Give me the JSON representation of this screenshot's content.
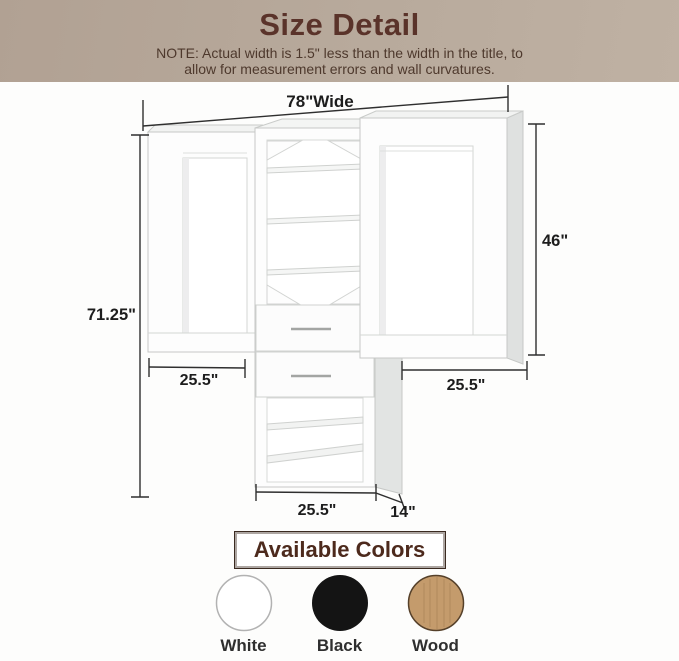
{
  "header": {
    "title": "Size Detail",
    "note_line1": "NOTE: Actual width is 1.5\" less than the width in the title, to",
    "note_line2": "allow for measurement errors and wall curvatures."
  },
  "diagram": {
    "product": "closet organizer system",
    "dimensions": {
      "total_width": "78\"Wide",
      "total_height": "71.25\"",
      "right_section_height": "46\"",
      "left_section_width": "25.5\"",
      "right_section_width": "25.5\"",
      "tower_width": "25.5\"",
      "tower_depth": "14\""
    }
  },
  "colors_section": {
    "title": "Available Colors",
    "options": [
      {
        "label": "White",
        "hex": "#ffffff"
      },
      {
        "label": "Black",
        "hex": "#141414"
      },
      {
        "label": "Wood",
        "hex": "#c49b6c"
      }
    ]
  }
}
